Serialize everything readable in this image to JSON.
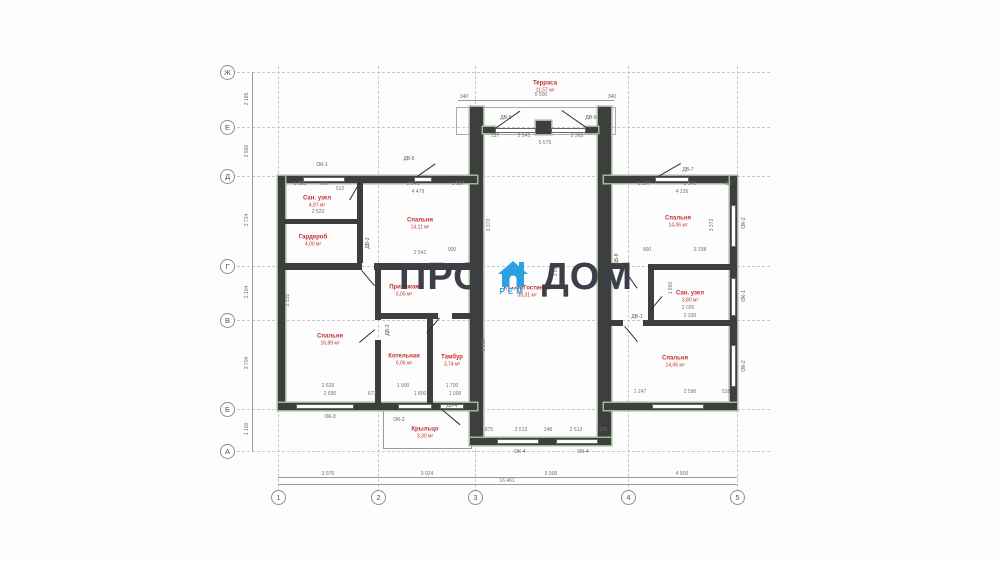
{
  "logo": {
    "left": "ПРО",
    "right": "ДОМ",
    "sub": "РЕМ",
    "icon": "house-icon",
    "text_color": "#3d3f48",
    "accent_color": "#2da0e0"
  },
  "axes": {
    "vertical": [
      {
        "label": "Ж",
        "y": 72
      },
      {
        "label": "Е",
        "y": 127
      },
      {
        "label": "Д",
        "y": 176
      },
      {
        "label": "Г",
        "y": 266
      },
      {
        "label": "В",
        "y": 320
      },
      {
        "label": "Б",
        "y": 409
      },
      {
        "label": "А",
        "y": 451
      }
    ],
    "horizontal": [
      {
        "label": "1",
        "x": 278
      },
      {
        "label": "2",
        "x": 378
      },
      {
        "label": "3",
        "x": 475
      },
      {
        "label": "4",
        "x": 628
      },
      {
        "label": "5",
        "x": 737
      }
    ]
  },
  "rooms": [
    {
      "name": "Терраса",
      "area": "11,57 м²",
      "x": 545,
      "y": 87
    },
    {
      "name": "Сан. узел",
      "area": "4,97 м²",
      "x": 317,
      "y": 202
    },
    {
      "name": "Спальня",
      "area": "14,11 м²",
      "x": 420,
      "y": 224
    },
    {
      "name": "Гардероб",
      "area": "4,00 м²",
      "x": 313,
      "y": 241
    },
    {
      "name": "Прихожая",
      "area": "5,05 м²",
      "x": 404,
      "y": 291
    },
    {
      "name": "Кухня-Гостиная",
      "area": "35,31 м²",
      "x": 527,
      "y": 292
    },
    {
      "name": "Спальня",
      "area": "16,89 м²",
      "x": 330,
      "y": 340
    },
    {
      "name": "Котельная",
      "area": "6,06 м²",
      "x": 404,
      "y": 360
    },
    {
      "name": "Тамбур",
      "area": "3,74 м²",
      "x": 452,
      "y": 361
    },
    {
      "name": "Крыльцо",
      "area": "3,30 м²",
      "x": 425,
      "y": 433
    },
    {
      "name": "Спальня",
      "area": "14,06 м²",
      "x": 678,
      "y": 222
    },
    {
      "name": "Сан. узел",
      "area": "3,80 м²",
      "x": 690,
      "y": 297
    },
    {
      "name": "Спальня",
      "area": "14,06 м²",
      "x": 675,
      "y": 362
    }
  ],
  "openings": [
    {
      "t": "ОК-1",
      "x": 322,
      "y": 165,
      "v": 0
    },
    {
      "t": "ДВ-6",
      "x": 409,
      "y": 159,
      "v": 0
    },
    {
      "t": "ДВ-9",
      "x": 506,
      "y": 118,
      "v": 0
    },
    {
      "t": "ДВ-9",
      "x": 591,
      "y": 118,
      "v": 0
    },
    {
      "t": "ДВ-7",
      "x": 688,
      "y": 170,
      "v": 0
    },
    {
      "t": "ОК-2",
      "x": 744,
      "y": 223,
      "v": 1
    },
    {
      "t": "ОК-1",
      "x": 744,
      "y": 296,
      "v": 1
    },
    {
      "t": "ОК-2",
      "x": 744,
      "y": 366,
      "v": 1
    },
    {
      "t": "ОК-3",
      "x": 330,
      "y": 417,
      "v": 0
    },
    {
      "t": "ОК-2",
      "x": 399,
      "y": 420,
      "v": 0
    },
    {
      "t": "ДВ-4",
      "x": 452,
      "y": 406,
      "v": 0
    },
    {
      "t": "ОК-4",
      "x": 520,
      "y": 452,
      "v": 0
    },
    {
      "t": "ОК-4",
      "x": 583,
      "y": 452,
      "v": 0
    },
    {
      "t": "ДВ-8",
      "x": 617,
      "y": 259,
      "v": 1
    },
    {
      "t": "ДВ-1",
      "x": 637,
      "y": 317,
      "v": 0
    },
    {
      "t": "ДВ-2",
      "x": 368,
      "y": 243,
      "v": 1
    },
    {
      "t": "ДВ-3",
      "x": 388,
      "y": 330,
      "v": 1
    }
  ],
  "dimensions": [
    {
      "t": "340",
      "x": 464,
      "y": 97,
      "v": 0
    },
    {
      "t": "5 500",
      "x": 541,
      "y": 95,
      "v": 0
    },
    {
      "t": "340",
      "x": 612,
      "y": 97,
      "v": 0
    },
    {
      "t": "137",
      "x": 495,
      "y": 136,
      "v": 0
    },
    {
      "t": "2 541",
      "x": 524,
      "y": 136,
      "v": 0
    },
    {
      "t": "2 365",
      "x": 577,
      "y": 136,
      "v": 0
    },
    {
      "t": "5 575",
      "x": 545,
      "y": 143,
      "v": 0
    },
    {
      "t": "2 185",
      "x": 247,
      "y": 99,
      "v": 1
    },
    {
      "t": "2 960",
      "x": 247,
      "y": 151,
      "v": 1
    },
    {
      "t": "3 724",
      "x": 247,
      "y": 220,
      "v": 1
    },
    {
      "t": "2 104",
      "x": 247,
      "y": 292,
      "v": 1
    },
    {
      "t": "3 704",
      "x": 247,
      "y": 363,
      "v": 1
    },
    {
      "t": "1 100",
      "x": 247,
      "y": 429,
      "v": 1
    },
    {
      "t": "1 382",
      "x": 300,
      "y": 184,
      "v": 0
    },
    {
      "t": "690",
      "x": 324,
      "y": 184,
      "v": 0
    },
    {
      "t": "512",
      "x": 340,
      "y": 189,
      "v": 0
    },
    {
      "t": "2 541",
      "x": 413,
      "y": 184,
      "v": 0
    },
    {
      "t": "1 587",
      "x": 458,
      "y": 184,
      "v": 0
    },
    {
      "t": "4 479",
      "x": 418,
      "y": 192,
      "v": 0
    },
    {
      "t": "1 167",
      "x": 644,
      "y": 184,
      "v": 0
    },
    {
      "t": "2 541",
      "x": 690,
      "y": 184,
      "v": 0
    },
    {
      "t": "487",
      "x": 728,
      "y": 184,
      "v": 0
    },
    {
      "t": "4 226",
      "x": 682,
      "y": 192,
      "v": 0
    },
    {
      "t": "2 523",
      "x": 318,
      "y": 212,
      "v": 0
    },
    {
      "t": "2 541",
      "x": 420,
      "y": 253,
      "v": 0
    },
    {
      "t": "900",
      "x": 452,
      "y": 250,
      "v": 0
    },
    {
      "t": "3 373",
      "x": 489,
      "y": 225,
      "v": 1
    },
    {
      "t": "3 680",
      "x": 556,
      "y": 270,
      "v": 1
    },
    {
      "t": "1 650",
      "x": 671,
      "y": 288,
      "v": 1
    },
    {
      "t": "3 373",
      "x": 712,
      "y": 225,
      "v": 1
    },
    {
      "t": "900",
      "x": 647,
      "y": 250,
      "v": 0
    },
    {
      "t": "3 338",
      "x": 700,
      "y": 250,
      "v": 0
    },
    {
      "t": "2 026",
      "x": 688,
      "y": 308,
      "v": 0
    },
    {
      "t": "2 330",
      "x": 690,
      "y": 316,
      "v": 0
    },
    {
      "t": "2 629",
      "x": 328,
      "y": 386,
      "v": 0
    },
    {
      "t": "1 900",
      "x": 403,
      "y": 386,
      "v": 0
    },
    {
      "t": "1 700",
      "x": 452,
      "y": 386,
      "v": 0
    },
    {
      "t": "2 590",
      "x": 330,
      "y": 394,
      "v": 0
    },
    {
      "t": "673",
      "x": 372,
      "y": 394,
      "v": 0
    },
    {
      "t": "1 800",
      "x": 420,
      "y": 394,
      "v": 0
    },
    {
      "t": "1 000",
      "x": 455,
      "y": 394,
      "v": 0
    },
    {
      "t": "1 247",
      "x": 640,
      "y": 392,
      "v": 0
    },
    {
      "t": "2 590",
      "x": 690,
      "y": 392,
      "v": 0
    },
    {
      "t": "518",
      "x": 726,
      "y": 392,
      "v": 0
    },
    {
      "t": "875",
      "x": 489,
      "y": 430,
      "v": 0
    },
    {
      "t": "2 513",
      "x": 521,
      "y": 430,
      "v": 0
    },
    {
      "t": "248",
      "x": 548,
      "y": 430,
      "v": 0
    },
    {
      "t": "2 513",
      "x": 576,
      "y": 430,
      "v": 0
    },
    {
      "t": "175",
      "x": 603,
      "y": 430,
      "v": 0
    },
    {
      "t": "3 100",
      "x": 484,
      "y": 345,
      "v": 1
    },
    {
      "t": "2 132",
      "x": 288,
      "y": 300,
      "v": 1
    },
    {
      "t": "3 976",
      "x": 328,
      "y": 474,
      "v": 0
    },
    {
      "t": "3 024",
      "x": 427,
      "y": 474,
      "v": 0
    },
    {
      "t": "5 000",
      "x": 551,
      "y": 474,
      "v": 0
    },
    {
      "t": "4 500",
      "x": 682,
      "y": 474,
      "v": 0
    },
    {
      "t": "16 461",
      "x": 507,
      "y": 481,
      "v": 0
    }
  ],
  "colors": {
    "wall": "#3e3e3e",
    "insulation": "#9fb99b",
    "room_label": "#c23131",
    "dim_text": "#707070",
    "grid": "#c7c8cc"
  }
}
